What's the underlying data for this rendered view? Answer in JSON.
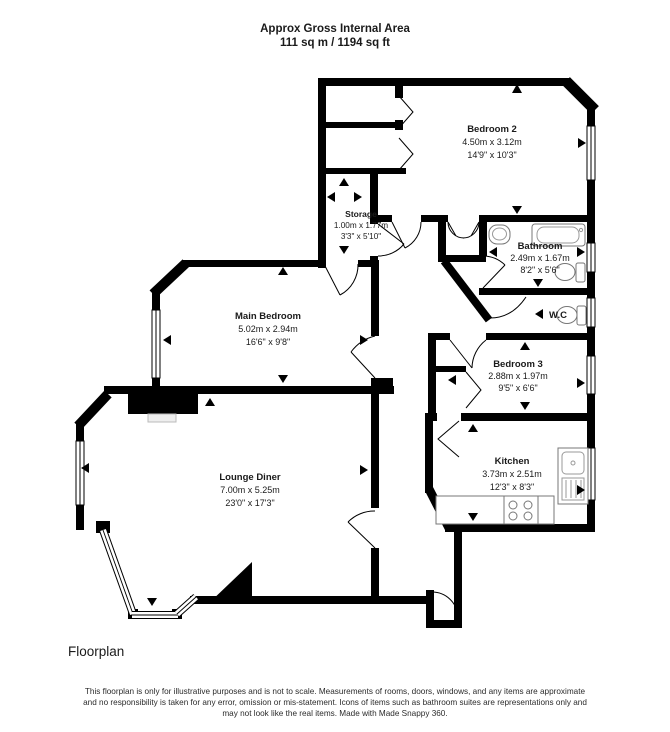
{
  "header": {
    "title": "Approx Gross Internal Area",
    "area": "111 sq m / 1194 sq ft"
  },
  "rooms": {
    "bedroom2": {
      "name": "Bedroom 2",
      "metric": "4.50m x 3.12m",
      "imperial": "14'9\" x 10'3\""
    },
    "storage": {
      "name": "Storage",
      "metric": "1.00m x 1.77m",
      "imperial": "3'3\" x 5'10\""
    },
    "bathroom": {
      "name": "Bathroom",
      "metric": "2.49m x 1.67m",
      "imperial": "8'2\" x 5'6\""
    },
    "wc": {
      "name": "W.C"
    },
    "main_bedroom": {
      "name": "Main Bedroom",
      "metric": "5.02m x 2.94m",
      "imperial": "16'6\" x 9'8\""
    },
    "bedroom3": {
      "name": "Bedroom 3",
      "metric": "2.88m x 1.97m",
      "imperial": "9'5\" x 6'6\""
    },
    "kitchen": {
      "name": "Kitchen",
      "metric": "3.73m x 2.51m",
      "imperial": "12'3\" x 8'3\""
    },
    "lounge": {
      "name": "Lounge Diner",
      "metric": "7.00m x 5.25m",
      "imperial": "23'0\" x 17'3\""
    }
  },
  "footer": {
    "caption": "Floorplan",
    "disclaimer": [
      "This floorplan is only for illustrative purposes and is not to scale. Measurements of rooms, doors, windows, and any items are approximate",
      "and no responsibility is taken for any error, omission or mis-statement. Icons of items such as bathroom suites are representations only and",
      "may not look like the real items. Made with Made Snappy 360."
    ]
  },
  "colors": {
    "wall": "#000000",
    "background": "#ffffff",
    "fixture_stroke": "#777777",
    "text": "#1a1a1a"
  }
}
